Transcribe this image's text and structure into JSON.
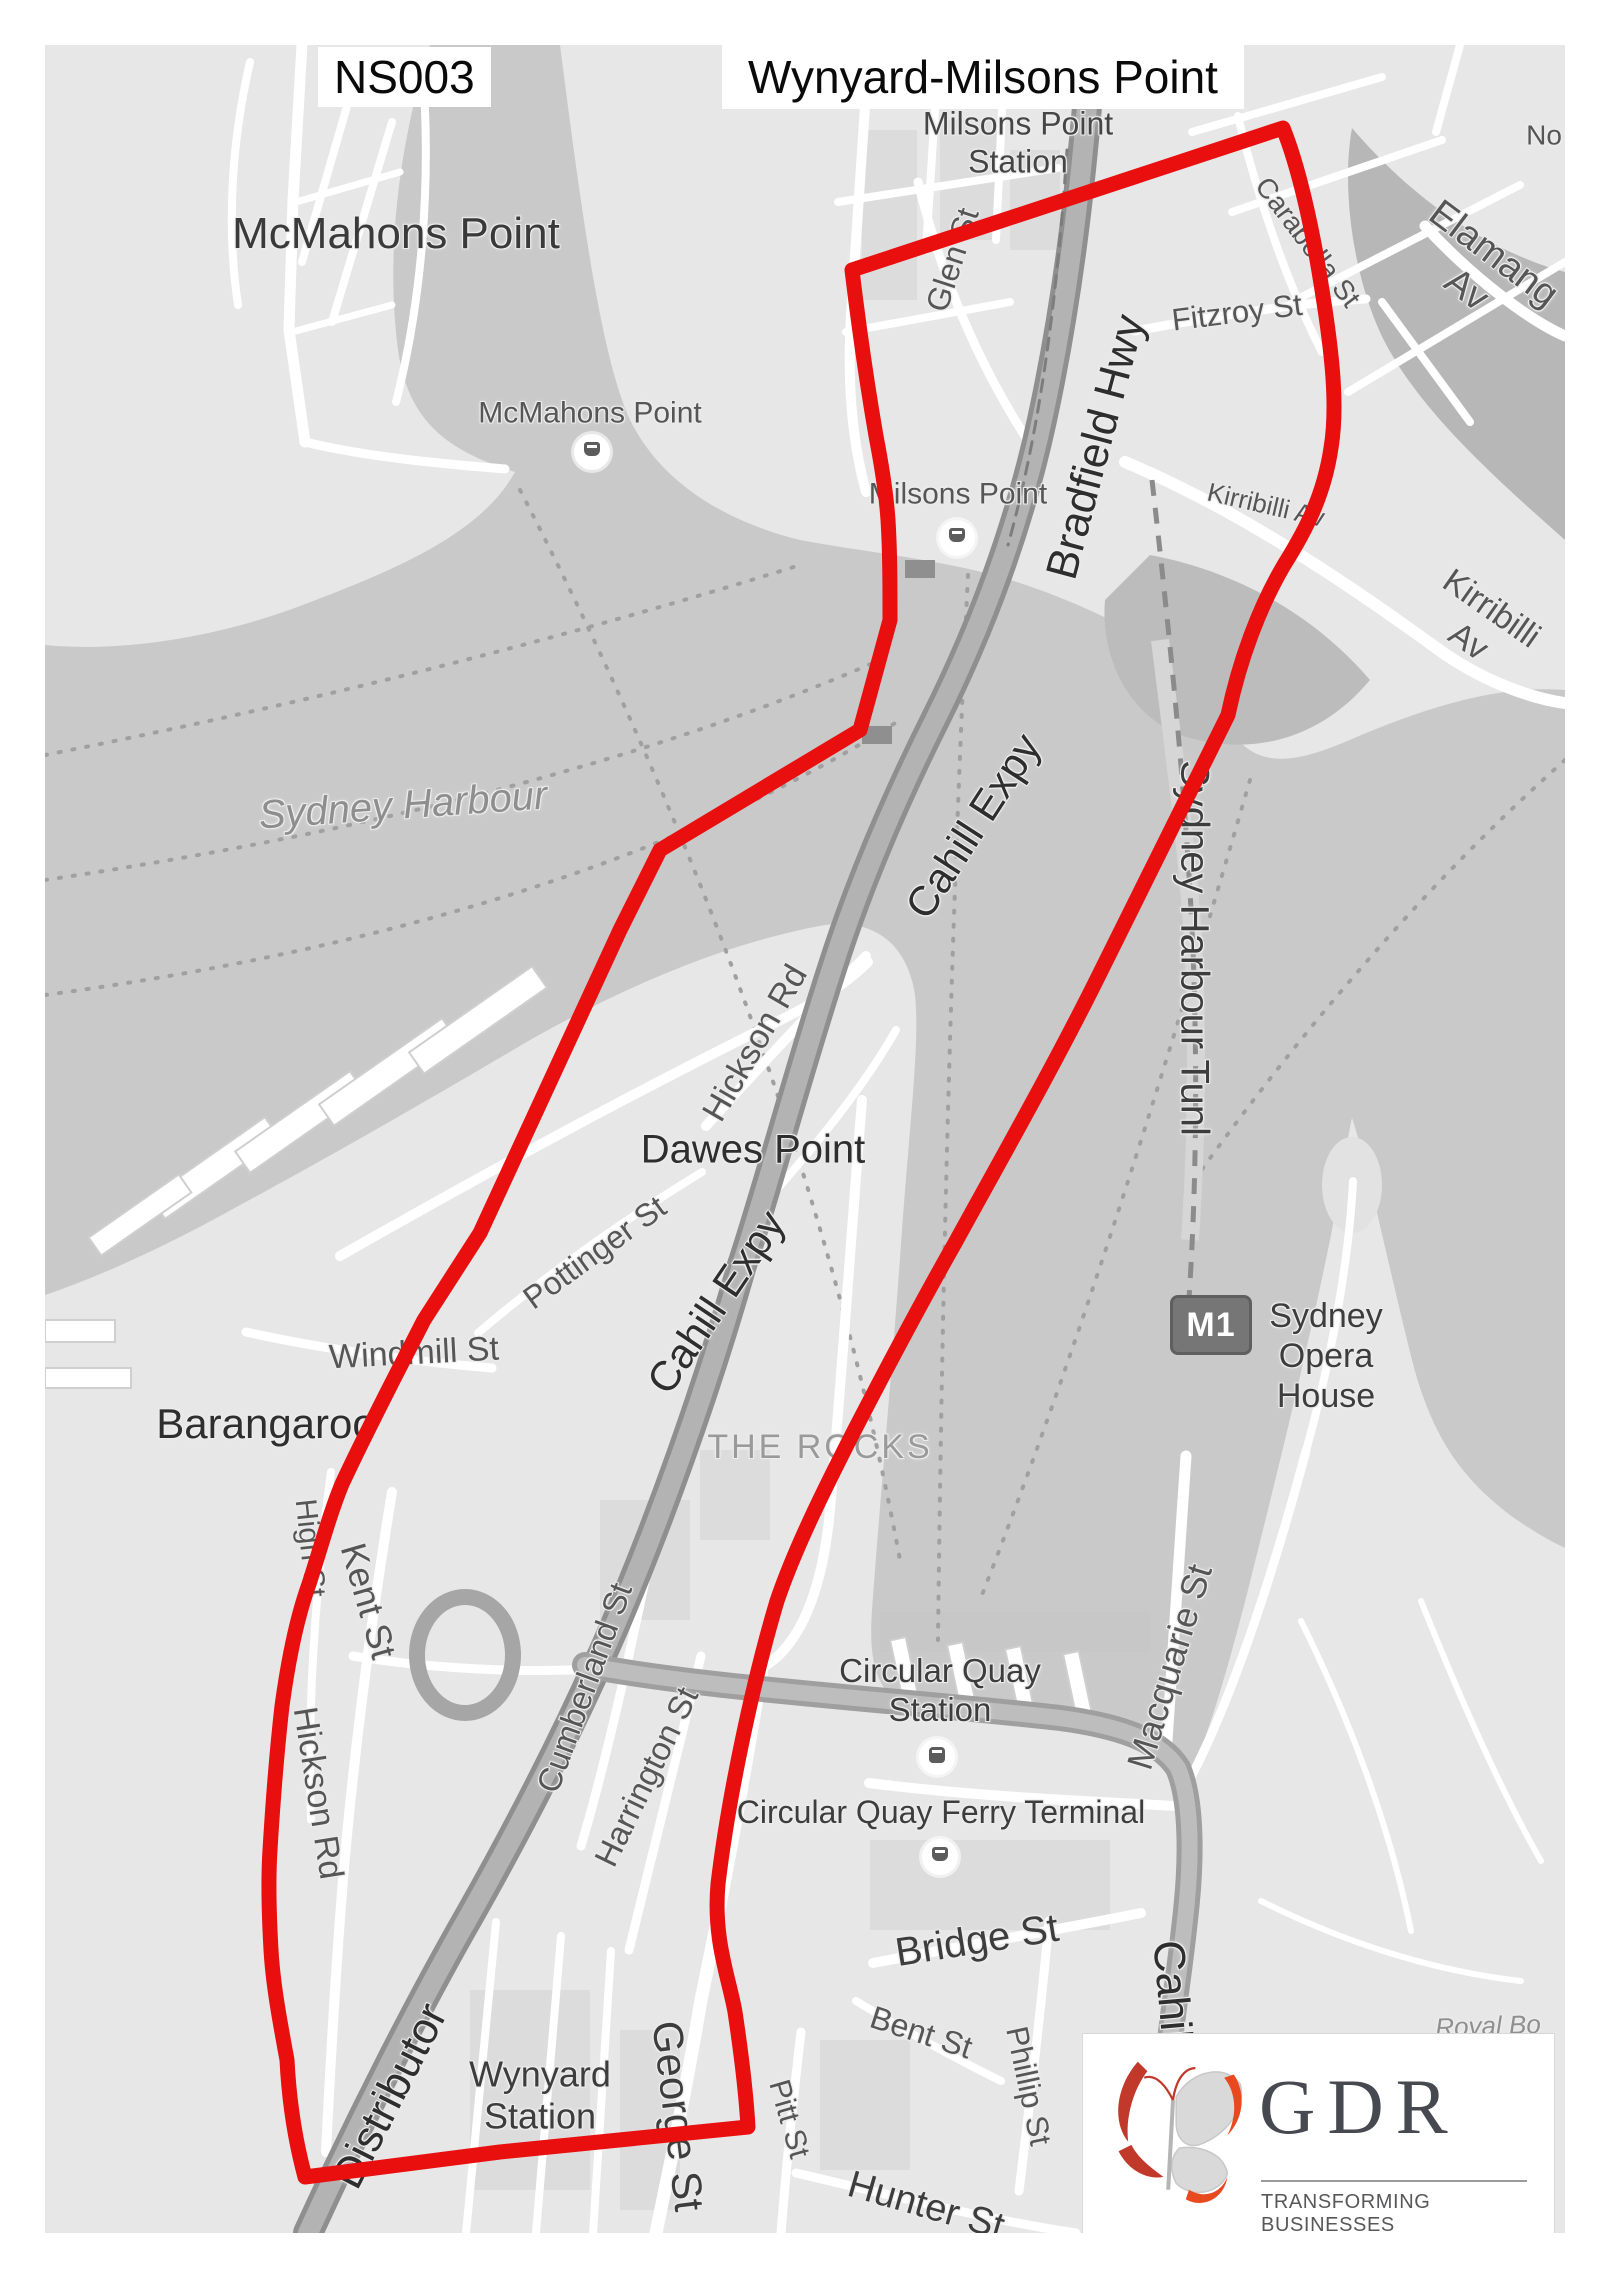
{
  "header": {
    "code": "NS003",
    "title": "Wynyard-Milsons Point"
  },
  "logo": {
    "name": "GDR",
    "tagline": "TRANSFORMING BUSINESSES"
  },
  "m1_badge": "M1",
  "colors": {
    "route": "#e90f0f",
    "water": "#c9c9c9",
    "land": "#e7e7e7",
    "dark_water": "#b7b7b7",
    "highway": "#9c9c9c",
    "logo_red": "#c0392b",
    "logo_text": "#474951"
  },
  "map": {
    "labels": [
      {
        "n": "milsons-point-station",
        "t": "Milsons Point\nStation",
        "x": 1018,
        "y": 143,
        "s": 32,
        "c": "#454545"
      },
      {
        "n": "mcmahons-point-suburb",
        "t": "McMahons Point",
        "x": 396,
        "y": 234,
        "s": 44,
        "c": "#3a3a3a"
      },
      {
        "n": "mcmahons-point-wharf",
        "t": "McMahons Point",
        "x": 590,
        "y": 413,
        "s": 30,
        "c": "#565656"
      },
      {
        "n": "glen-st",
        "t": "Glen St",
        "x": 953,
        "y": 260,
        "s": 32,
        "r": -72,
        "c": "#565656"
      },
      {
        "n": "fitzroy-st",
        "t": "Fitzroy St",
        "x": 1237,
        "y": 313,
        "s": 31,
        "r": -7,
        "c": "#565656"
      },
      {
        "n": "carabella-st",
        "t": "Carabella St",
        "x": 1308,
        "y": 242,
        "s": 28,
        "r": 53,
        "c": "#565656"
      },
      {
        "n": "elamang-av",
        "t": "Elamang Av",
        "x": 1480,
        "y": 272,
        "s": 38,
        "r": 37,
        "c": "#565656"
      },
      {
        "n": "north-partial",
        "t": "No",
        "x": 1544,
        "y": 135,
        "s": 28,
        "c": "#565656"
      },
      {
        "n": "kirribilli-av-small",
        "t": "Kirribilli Av",
        "x": 1266,
        "y": 505,
        "s": 26,
        "r": 13,
        "c": "#565656"
      },
      {
        "n": "kirribilli-av-large",
        "t": "Kirribilli Av",
        "x": 1480,
        "y": 625,
        "s": 34,
        "r": 35,
        "c": "#565656"
      },
      {
        "n": "bradfield-hwy",
        "t": "Bradfield Hwy",
        "x": 1096,
        "y": 447,
        "s": 44,
        "r": -75,
        "c": "#2e2e2e"
      },
      {
        "n": "milsons-point-wharf-label",
        "t": "Milsons Point",
        "x": 958,
        "y": 494,
        "s": 30,
        "c": "#565656"
      },
      {
        "n": "sydney-harbour",
        "t": "Sydney Harbour",
        "x": 403,
        "y": 806,
        "s": 40,
        "r": -4,
        "i": 1,
        "c": "#8e8e8e"
      },
      {
        "n": "cahill-expy-upper",
        "t": "Cahill Expy",
        "x": 973,
        "y": 826,
        "s": 42,
        "r": -57,
        "c": "#2e2e2e"
      },
      {
        "n": "sydney-harbour-tunnel",
        "t": "Sydney Harbour Tunl",
        "x": 1194,
        "y": 948,
        "s": 40,
        "r": 90,
        "c": "#3d3d3d"
      },
      {
        "n": "hickson-rd-upper",
        "t": "Hickson Rd",
        "x": 755,
        "y": 1043,
        "s": 34,
        "r": -60,
        "c": "#565656"
      },
      {
        "n": "dawes-point",
        "t": "Dawes Point",
        "x": 753,
        "y": 1150,
        "s": 40,
        "c": "#2e2e2e"
      },
      {
        "n": "pottinger-st",
        "t": "Pottinger St",
        "x": 595,
        "y": 1253,
        "s": 32,
        "r": -36,
        "c": "#565656"
      },
      {
        "n": "cahill-expy-lower",
        "t": "Cahill Expy",
        "x": 716,
        "y": 1302,
        "s": 42,
        "r": -56,
        "c": "#2e2e2e"
      },
      {
        "n": "windmill-st",
        "t": "Windmill St",
        "x": 414,
        "y": 1353,
        "s": 34,
        "r": -3,
        "c": "#565656"
      },
      {
        "n": "barangaroo",
        "t": "Barangaroo",
        "x": 266,
        "y": 1424,
        "s": 42,
        "c": "#2e2e2e"
      },
      {
        "n": "the-rocks",
        "t": "THE ROCKS",
        "x": 820,
        "y": 1447,
        "s": 34,
        "ls": 3,
        "c": "#9a9a9a"
      },
      {
        "n": "sydney-opera-house",
        "t": "Sydney\nOpera\nHouse",
        "x": 1326,
        "y": 1356,
        "s": 34,
        "c": "#3d3d3d"
      },
      {
        "n": "high-st",
        "t": "High St",
        "x": 310,
        "y": 1548,
        "s": 30,
        "r": 84,
        "c": "#565656"
      },
      {
        "n": "kent-st",
        "t": "Kent St",
        "x": 368,
        "y": 1601,
        "s": 36,
        "r": 74,
        "c": "#565656"
      },
      {
        "n": "hickson-rd-lower",
        "t": "Hickson Rd",
        "x": 318,
        "y": 1793,
        "s": 34,
        "r": 81,
        "c": "#565656"
      },
      {
        "n": "cumberland-st",
        "t": "Cumberland St",
        "x": 585,
        "y": 1688,
        "s": 33,
        "r": -70,
        "c": "#565656"
      },
      {
        "n": "harrington-st",
        "t": "Harrington St",
        "x": 647,
        "y": 1777,
        "s": 33,
        "r": -64,
        "c": "#565656"
      },
      {
        "n": "circular-quay-station",
        "t": "Circular Quay\nStation",
        "x": 940,
        "y": 1691,
        "s": 33,
        "c": "#3d3d3d"
      },
      {
        "n": "circular-quay-ferry-terminal",
        "t": "Circular Quay Ferry Terminal",
        "x": 941,
        "y": 1813,
        "s": 32,
        "c": "#3d3d3d"
      },
      {
        "n": "macquarie-st",
        "t": "Macquarie St",
        "x": 1170,
        "y": 1667,
        "s": 36,
        "r": -73,
        "c": "#565656"
      },
      {
        "n": "bridge-st",
        "t": "Bridge St",
        "x": 977,
        "y": 1941,
        "s": 40,
        "r": -9,
        "c": "#3d3d3d"
      },
      {
        "n": "bent-st",
        "t": "Bent St",
        "x": 921,
        "y": 2033,
        "s": 32,
        "r": 18,
        "c": "#565656"
      },
      {
        "n": "phillip-st",
        "t": "Phillip St",
        "x": 1028,
        "y": 2086,
        "s": 31,
        "r": 78,
        "c": "#565656"
      },
      {
        "n": "pitt-st",
        "t": "Pitt St",
        "x": 789,
        "y": 2119,
        "s": 30,
        "r": 74,
        "c": "#565656"
      },
      {
        "n": "george-st",
        "t": "George St",
        "x": 678,
        "y": 2116,
        "s": 42,
        "r": 83,
        "c": "#3d3d3d"
      },
      {
        "n": "wynyard-station",
        "t": "Wynyard\nStation",
        "x": 540,
        "y": 2096,
        "s": 36,
        "c": "#3d3d3d"
      },
      {
        "n": "hunter-st",
        "t": "Hunter St",
        "x": 926,
        "y": 2206,
        "s": 38,
        "r": 16,
        "c": "#3d3d3d"
      },
      {
        "n": "distributor",
        "t": "Distributor",
        "x": 390,
        "y": 2096,
        "s": 44,
        "r": -63,
        "c": "#2e2e2e"
      },
      {
        "n": "cahill-expy-south",
        "t": "Cahill Expy",
        "x": 1177,
        "y": 2050,
        "s": 44,
        "r": 85,
        "c": "#2e2e2e"
      },
      {
        "n": "royal-botanic-partial",
        "t": "Royal Bo",
        "x": 1488,
        "y": 2026,
        "s": 26,
        "i": 1,
        "r": -2,
        "c": "#8f8f8f"
      }
    ],
    "icons": [
      {
        "n": "ferry-wharf-mcmahons-point",
        "type": "ferry",
        "x": 592,
        "y": 452
      },
      {
        "n": "ferry-wharf-milsons-point",
        "type": "ferry",
        "x": 957,
        "y": 538
      },
      {
        "n": "ferry-wharf-circular-quay",
        "type": "ferry",
        "x": 940,
        "y": 1857
      },
      {
        "n": "train-station-circular-quay",
        "type": "train",
        "x": 937,
        "y": 1757
      }
    ]
  }
}
